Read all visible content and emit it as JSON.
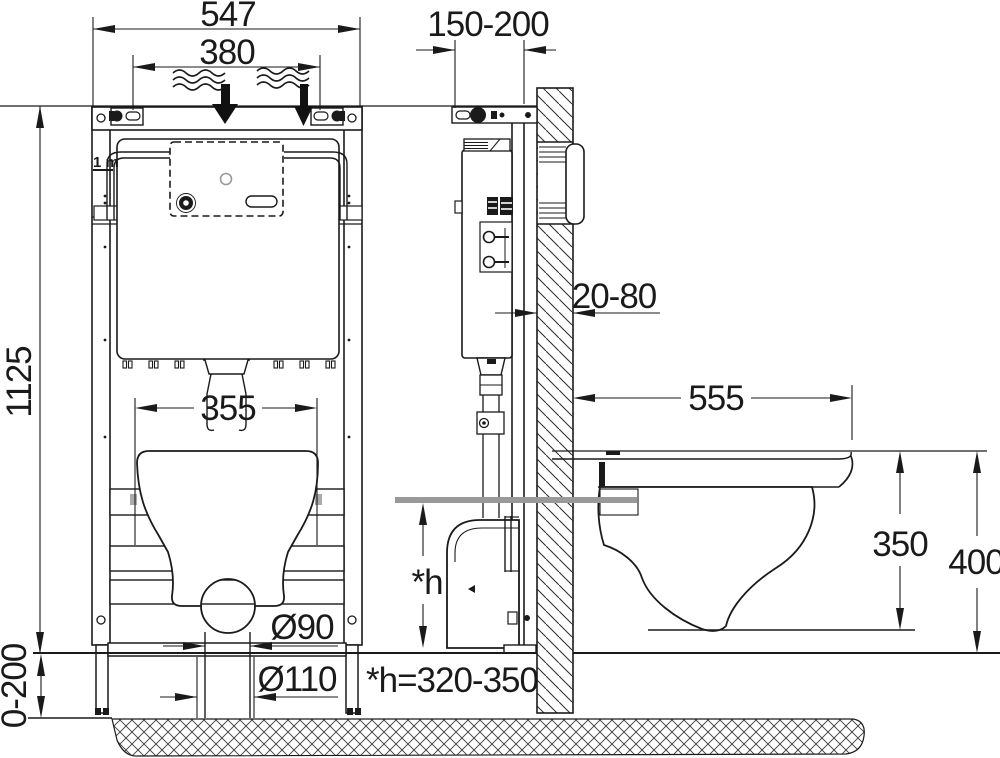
{
  "drawing": {
    "type": "technical installation drawing",
    "subject": "wall-hung WC concealed cistern mounting frame, front and side views",
    "colors": {
      "line": "#1a1a1a",
      "highlight_gray": "#999999",
      "background": "#ffffff"
    }
  },
  "labels": {
    "frame_width": "547",
    "hanger_spacing": "380",
    "frame_height": "1125",
    "installation_depth": "150-200",
    "cladding_thickness": "20-80",
    "bowl_mount_width": "355",
    "bowl_depth": "555",
    "rim_to_outlet_drop": "350",
    "rim_height": "400",
    "outlet_pipe_diameter": "Ø90",
    "floor_drain_diameter": "Ø110",
    "leg_extension": "0-200",
    "flush_height_symbol": "*h",
    "flush_height_value": "*h=320-350",
    "meter_mark": "1 m"
  }
}
